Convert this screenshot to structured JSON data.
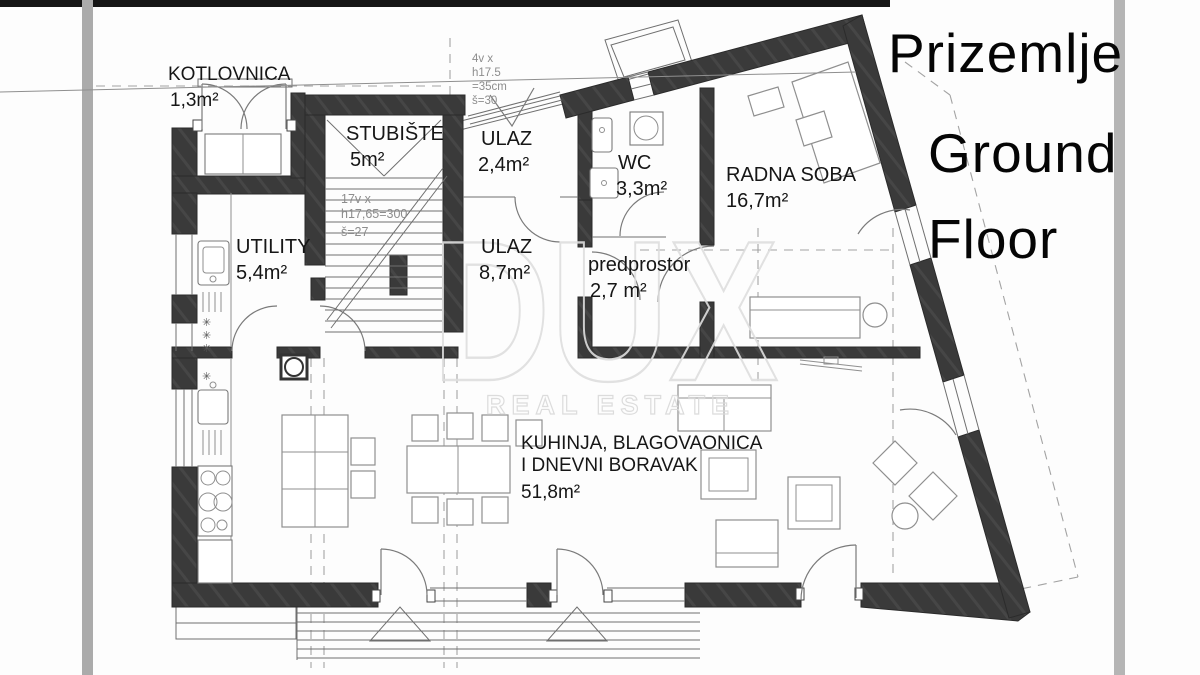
{
  "title": {
    "line1": "Prizemlje",
    "line2": "Ground",
    "line3": "Floor"
  },
  "watermark": {
    "brand": "DUX",
    "tagline": "REAL ESTATE"
  },
  "rooms": [
    {
      "name": "KOTLOVNICA",
      "area": "1,3m²"
    },
    {
      "name": "STUBIŠTE",
      "area": "5m²"
    },
    {
      "name": "ULAZ",
      "area": "2,4m²"
    },
    {
      "name": "WC",
      "area": "3,3m²"
    },
    {
      "name": "RADNA SOBA",
      "area": "16,7m²"
    },
    {
      "name": "UTILITY",
      "area": "5,4m²"
    },
    {
      "name": "ULAZ",
      "area": "8,7m²"
    },
    {
      "name": "predprostor",
      "area": "2,7 m²"
    },
    {
      "name_line1": "KUHINJA, BLAGOVAONICA",
      "name_line2": "I DNEVNI BORAVAK",
      "area": "51,8m²"
    }
  ],
  "annotations": {
    "entry_steps": [
      "4v x",
      "h17.5",
      "=35cm",
      "š=30"
    ],
    "stair_note": [
      "17v x",
      "h17,65=300",
      "š=27"
    ]
  },
  "colors": {
    "wall": "#3a3a3a",
    "photo_bar": "#ababab",
    "watermark": "#dedede"
  }
}
